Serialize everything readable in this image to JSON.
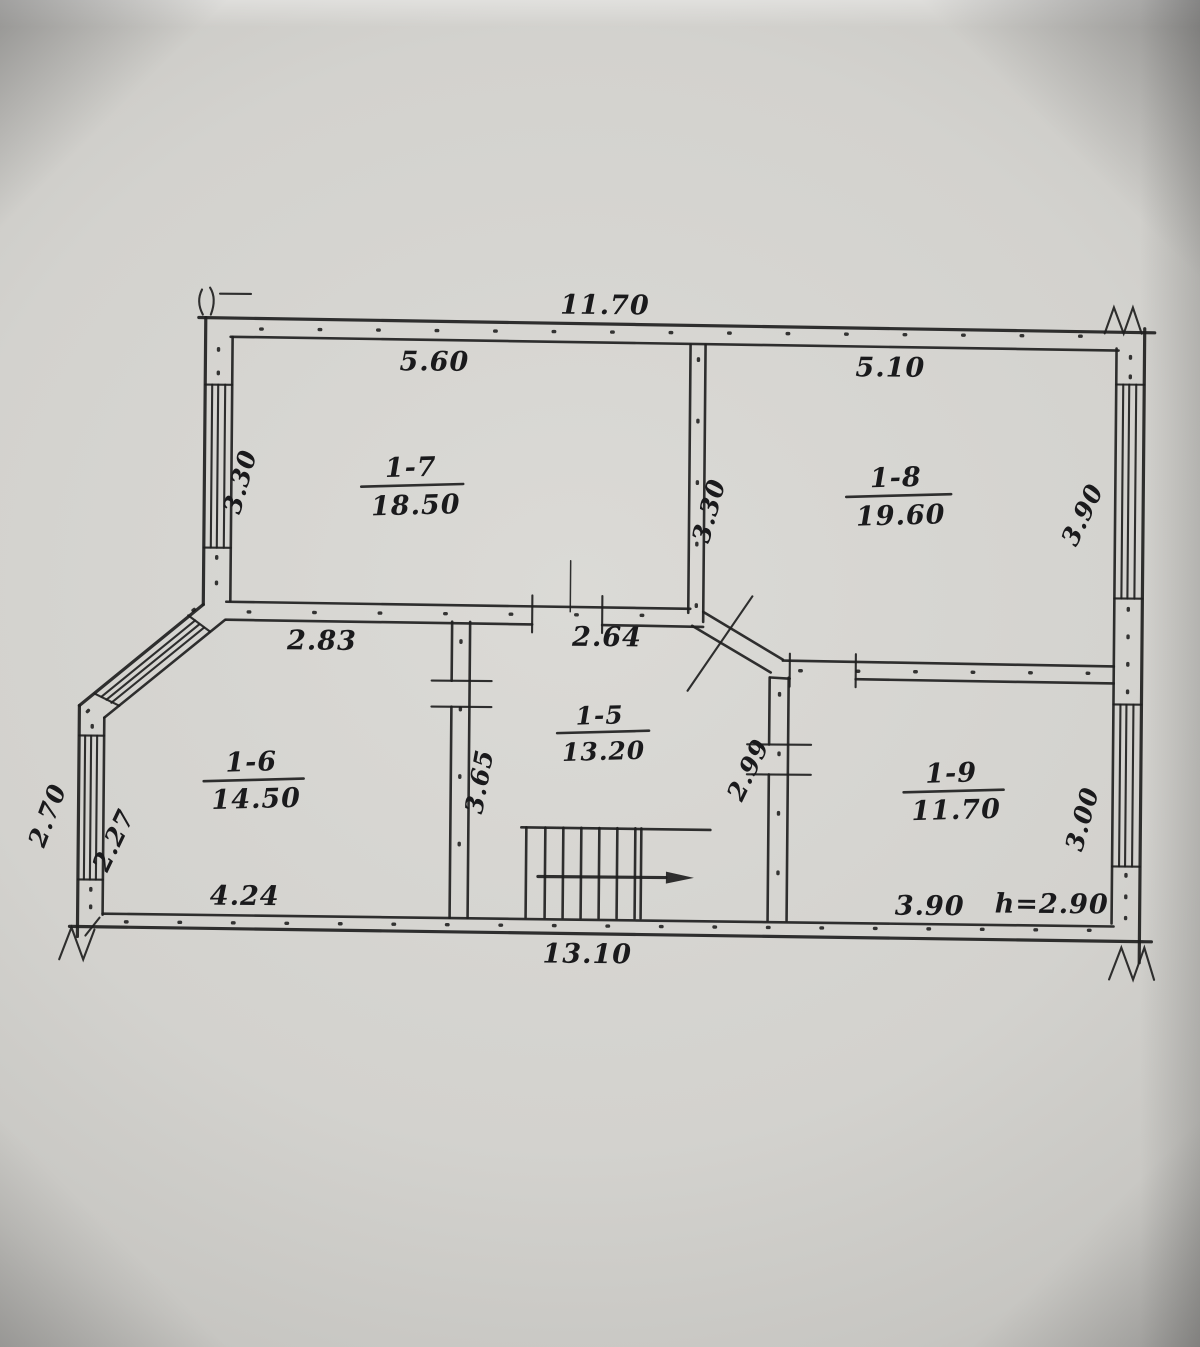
{
  "floorplan": {
    "rooms": [
      {
        "id": "1-7",
        "area": "18.50"
      },
      {
        "id": "1-8",
        "area": "19.60"
      },
      {
        "id": "1-5",
        "area": "13.20"
      },
      {
        "id": "1-6",
        "area": "14.50"
      },
      {
        "id": "1-9",
        "area": "11.70"
      }
    ],
    "dims": {
      "top_overall": "11.70",
      "room17_width": "5.60",
      "room18_width": "5.10",
      "left_upper_height": "3.30",
      "mid_wall_height": "3.30",
      "right_upper_height": "3.90",
      "wall_seg_left": "2.83",
      "wall_seg_right": "2.64",
      "room15_height": "3.65",
      "room19_height_left": "2.99",
      "left_lower_outer": "2.70",
      "left_lower_inner": "2.27",
      "right_lower_height": "3.00",
      "room16_width": "4.24",
      "bottom_overall": "13.10",
      "room19_width": "3.90",
      "ceiling_height": "h=2.90"
    }
  }
}
